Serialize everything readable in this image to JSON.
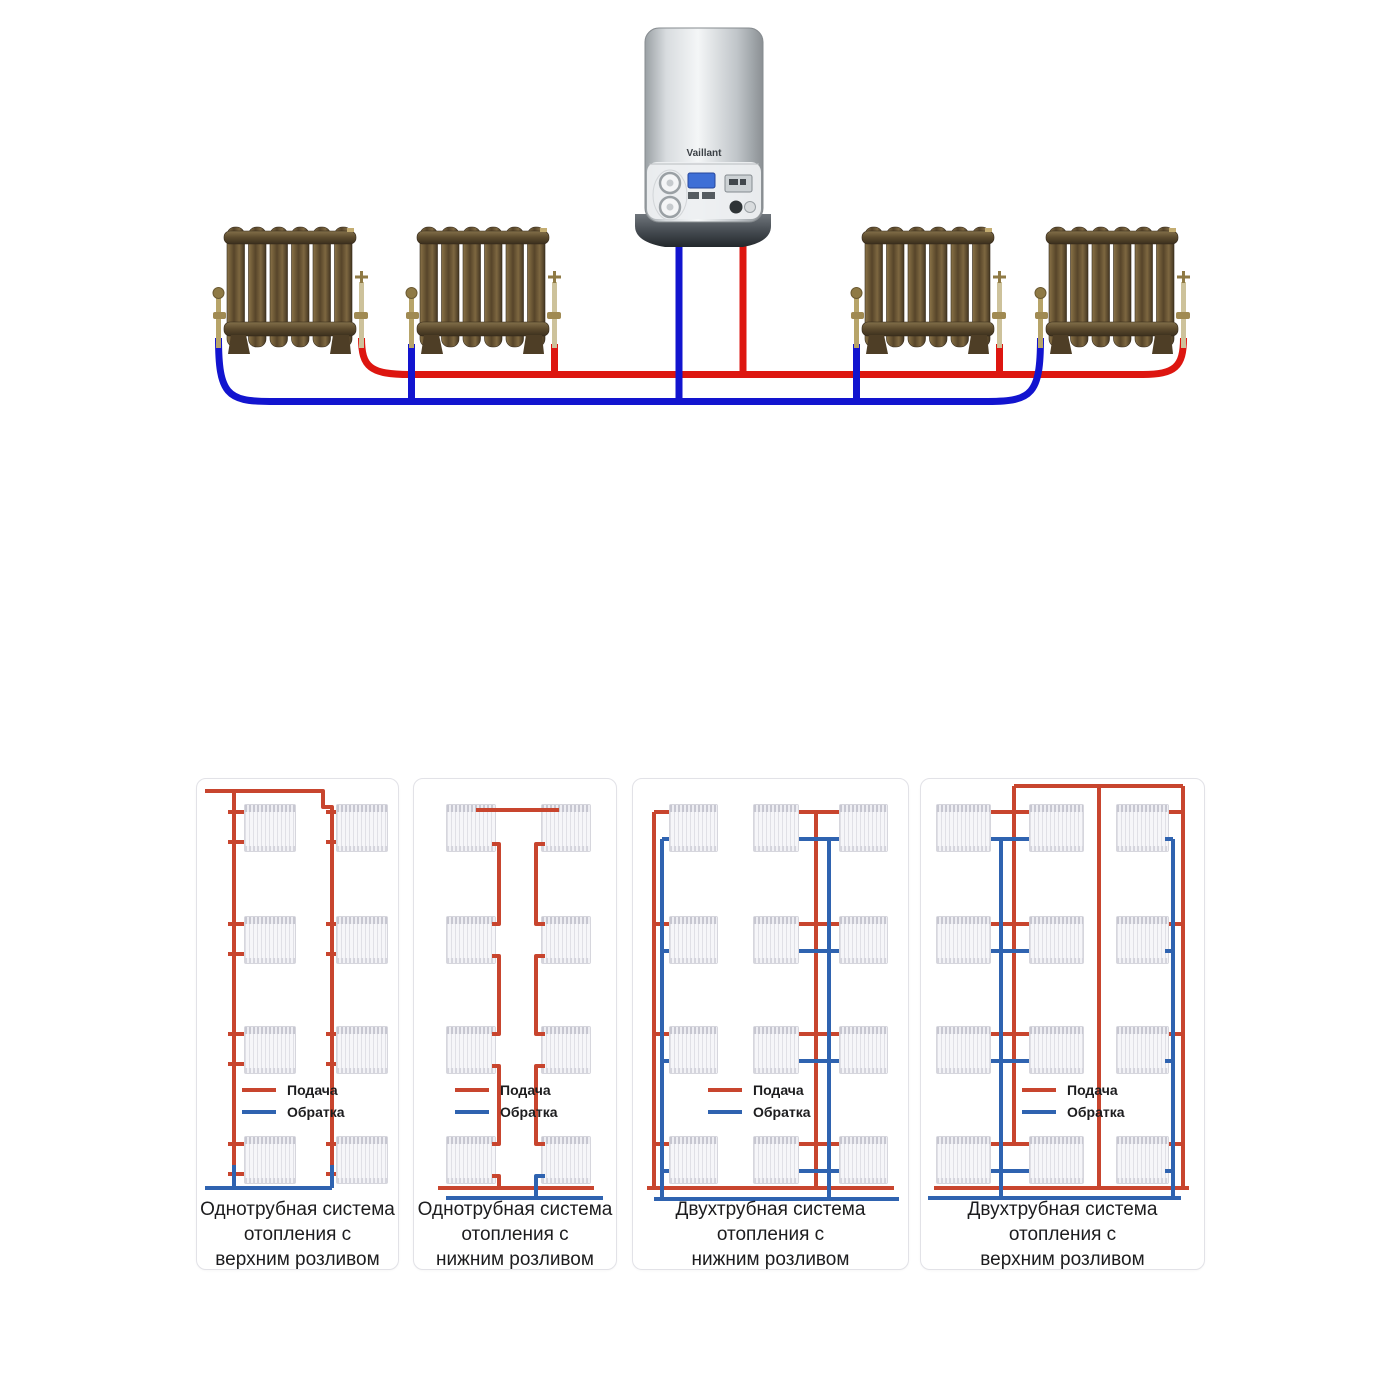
{
  "colors": {
    "supply": "#dd1610",
    "return": "#1214cf",
    "panel_supply": "#c8452e",
    "panel_return": "#2f63b0"
  },
  "boiler": {
    "brand": "Vaillant"
  },
  "legend": {
    "supply": "Подача",
    "return": "Обратка"
  },
  "panels": [
    {
      "caption_lines": [
        "Однотрубная система",
        "отопления с",
        "верхним розливом"
      ]
    },
    {
      "caption_lines": [
        "Однотрубная система",
        "отопления с",
        "нижним розливом"
      ]
    },
    {
      "caption_lines": [
        "Двухтрубная система",
        "отопления с",
        "нижним розливом"
      ]
    },
    {
      "caption_lines": [
        "Двухтрубная система",
        "отопления с",
        "верхним розливом"
      ]
    }
  ]
}
